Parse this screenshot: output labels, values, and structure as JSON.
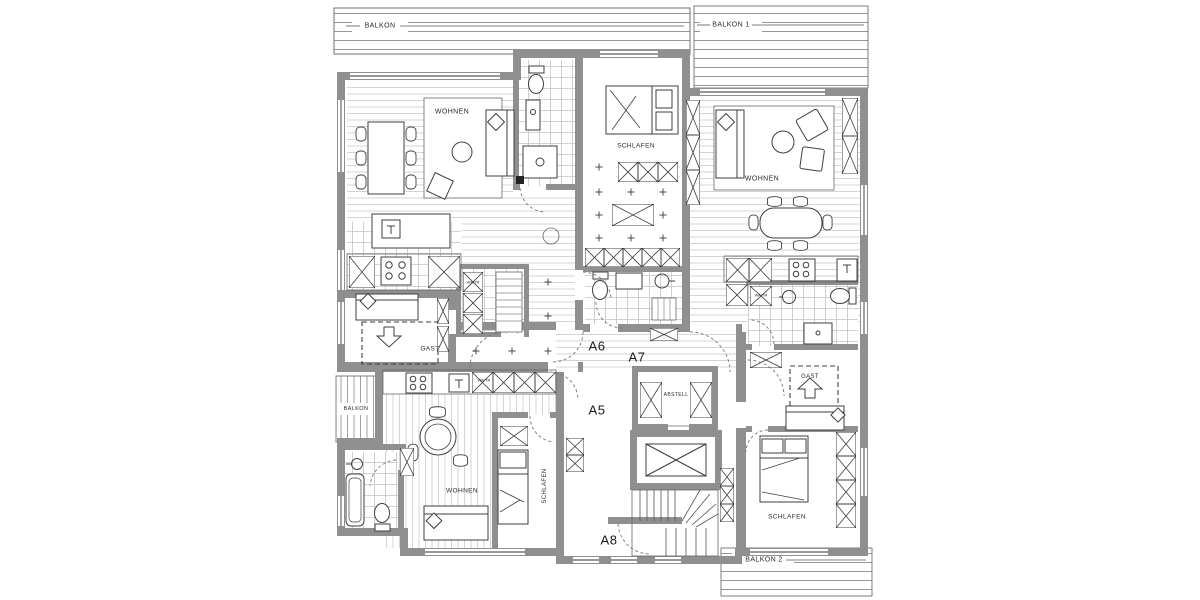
{
  "plan": {
    "balconies": {
      "top_left": "BALKON",
      "top_right": "BALKON 1",
      "bottom_right": "BALKON 2",
      "unit_a5": "BALKON"
    },
    "units": {
      "a5": "A5",
      "a6": "A6",
      "a7": "A7",
      "a8": "A8"
    },
    "rooms": {
      "living_left": "WOHNEN",
      "living_right": "WOHNEN",
      "living_a5": "WOHNEN",
      "bedroom_middle": "SCHLAFEN",
      "bedroom_right": "SCHLAFEN",
      "bedroom_a5": "SCHLAFEN",
      "guest_left": "GAST",
      "guest_right": "GAST",
      "storage": "ABSTELL",
      "laundry_left": "WA/TR",
      "laundry_a5": "WA/TR",
      "laundry_right": "WA/TR"
    },
    "colors": {
      "wall": "#8f8f8f",
      "line": "#3f3f3f",
      "floor_hatch": "#d4d4d4",
      "tile_grid": "#c4c4c4",
      "balcony_hatch": "#979797"
    }
  }
}
